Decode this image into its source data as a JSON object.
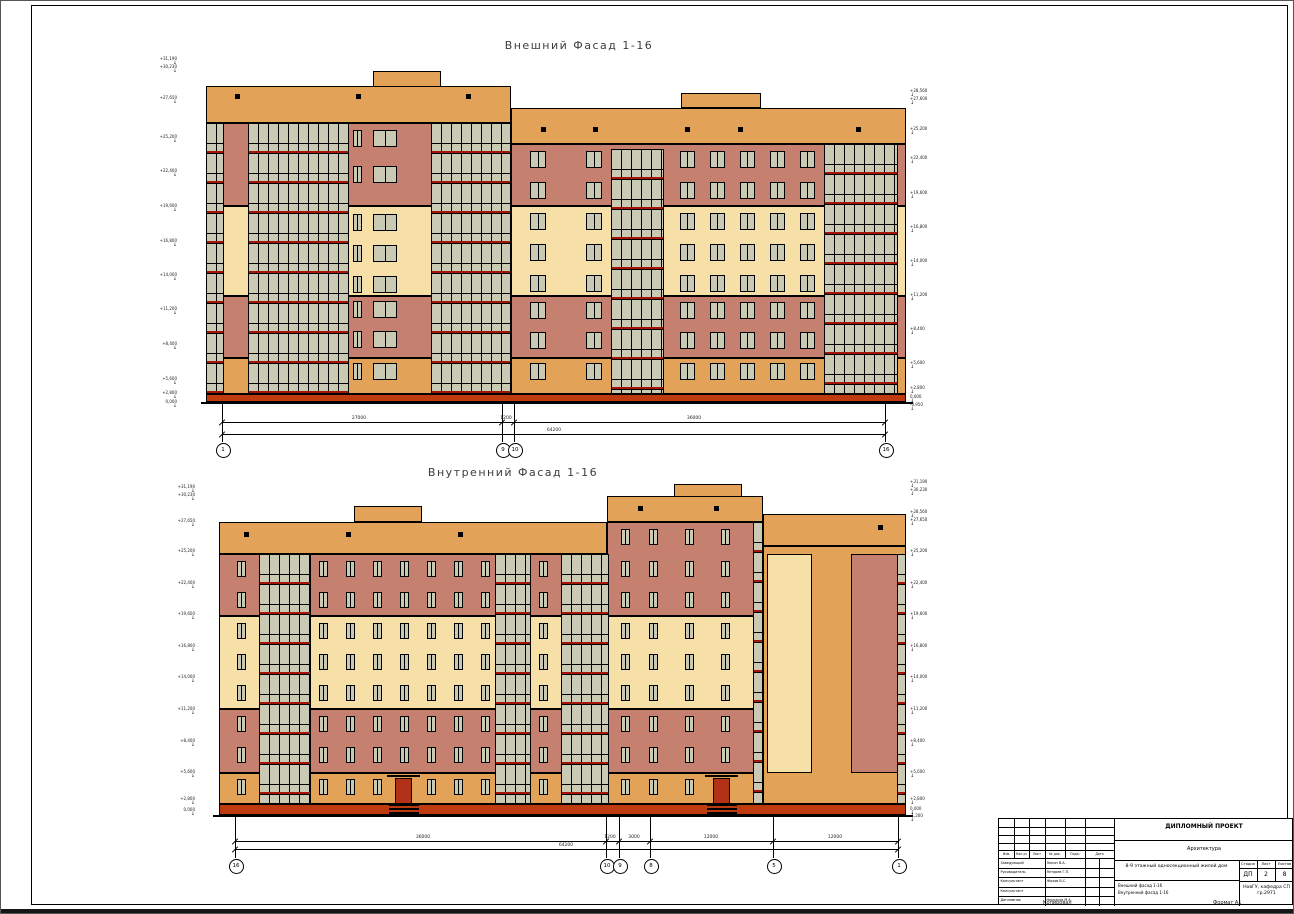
{
  "colors": {
    "orange": "#E2A257",
    "salmon": "#C6806F",
    "cream": "#F6E0A8",
    "pane": "#C9C9B4",
    "red": "#A51505",
    "plinth": "#BE3B10",
    "door": "#B23217"
  },
  "titles": {
    "facade_external": "Внешний Фасад 1-16",
    "facade_internal": "Внутренний Фасад 1-16"
  },
  "footer": {
    "copied": "Копировал",
    "format": "Формат А1"
  },
  "titleblock": {
    "project": "ДИПЛОМНЫЙ ПРОЕКТ",
    "department": "Архитектура",
    "object": "8-9 этажный односекционный жилой дом",
    "sheet_line1": "Внешний фасад 1-16",
    "sheet_line2": "Внутренний фасад 1-16",
    "stage_header": "Стадия",
    "list_header": "Лист",
    "lists_header": "Листов",
    "stage": "ДП",
    "list": "2",
    "lists": "8",
    "org": "НовГУ, кафедра СП гр.2971",
    "rev_headers": [
      "Изм.",
      "Кол.уч",
      "Лист",
      "№ док.",
      "Подп.",
      "Дата"
    ],
    "signature_rows": [
      [
        "Заведующий",
        "Ланин В.А."
      ],
      [
        "Руководитель",
        "Янтарев Г.П."
      ],
      [
        "Консультант",
        "Жохов В.С."
      ],
      [
        "Консультант",
        ""
      ],
      [
        "Дипломник",
        "Некрасов М.А."
      ]
    ]
  },
  "drawing": {
    "rects": [
      [
        372,
        70,
        68,
        16,
        "orange"
      ],
      [
        205,
        85,
        305,
        37,
        "orange"
      ],
      [
        680,
        92,
        80,
        15,
        "orange"
      ],
      [
        510,
        107,
        395,
        36,
        "orange"
      ],
      [
        205,
        122,
        305,
        83,
        "salmon"
      ],
      [
        205,
        205,
        305,
        90,
        "cream"
      ],
      [
        205,
        295,
        305,
        62,
        "salmon"
      ],
      [
        205,
        357,
        305,
        36,
        "orange"
      ],
      [
        510,
        143,
        395,
        62,
        "salmon"
      ],
      [
        510,
        205,
        395,
        90,
        "cream"
      ],
      [
        510,
        295,
        395,
        62,
        "salmon"
      ],
      [
        510,
        357,
        395,
        36,
        "orange"
      ],
      [
        205,
        393,
        700,
        8,
        "plinth"
      ],
      [
        353,
        505,
        68,
        16,
        "orange"
      ],
      [
        218,
        521,
        388,
        32,
        "orange"
      ],
      [
        673,
        483,
        68,
        13,
        "orange"
      ],
      [
        606,
        495,
        156,
        26,
        "orange"
      ],
      [
        762,
        513,
        143,
        32,
        "orange"
      ],
      [
        218,
        553,
        388,
        62,
        "salmon"
      ],
      [
        218,
        615,
        388,
        93,
        "cream"
      ],
      [
        218,
        708,
        388,
        64,
        "salmon"
      ],
      [
        218,
        772,
        388,
        31,
        "orange"
      ],
      [
        606,
        521,
        156,
        94,
        "salmon"
      ],
      [
        606,
        615,
        156,
        93,
        "cream"
      ],
      [
        606,
        708,
        156,
        64,
        "salmon"
      ],
      [
        606,
        772,
        156,
        31,
        "orange"
      ],
      [
        762,
        545,
        143,
        258,
        "orange"
      ],
      [
        766,
        553,
        45,
        219,
        "cream"
      ],
      [
        850,
        553,
        48,
        219,
        "salmon"
      ],
      [
        218,
        803,
        687,
        11,
        "plinth"
      ]
    ],
    "glazing": [
      [
        205,
        122,
        18,
        271
      ],
      [
        247,
        122,
        101,
        271
      ],
      [
        430,
        122,
        80,
        271
      ],
      [
        610,
        148,
        53,
        245
      ],
      [
        823,
        143,
        74,
        250
      ],
      [
        258,
        553,
        52,
        250
      ],
      [
        494,
        553,
        36,
        250
      ],
      [
        560,
        553,
        48,
        250
      ],
      [
        752,
        521,
        10,
        282
      ],
      [
        896,
        553,
        9,
        250
      ]
    ],
    "window_sets": [
      {
        "cols": [
          352
        ],
        "w": 9,
        "rows": [
          129,
          165,
          213,
          244,
          275,
          300,
          330,
          362
        ],
        "h": 17
      },
      {
        "cols": [
          372
        ],
        "w": 24,
        "rows": [
          129,
          165,
          213,
          244,
          275,
          300,
          330,
          362
        ],
        "h": 17
      },
      {
        "cols": [
          529,
          585
        ],
        "w": 16,
        "rows": [
          150,
          181,
          212,
          243,
          274,
          301,
          331,
          362
        ],
        "h": 17
      },
      {
        "cols": [
          679,
          709,
          739,
          769,
          799
        ],
        "w": 15,
        "rows": [
          150,
          181,
          212,
          243,
          274,
          301,
          331,
          362
        ],
        "h": 17
      },
      {
        "cols": [
          236,
          318,
          345,
          372,
          399,
          426,
          453,
          480,
          538
        ],
        "w": 9,
        "rows": [
          560,
          591,
          622,
          653,
          684,
          715,
          746,
          778
        ],
        "h": 16
      },
      {
        "cols": [
          620,
          648,
          684,
          720
        ],
        "w": 9,
        "rows": [
          528,
          560,
          591,
          622,
          653,
          684,
          715,
          746,
          778
        ],
        "h": 16
      }
    ],
    "squares": [
      [
        234,
        93
      ],
      [
        355,
        93
      ],
      [
        465,
        93
      ],
      [
        540,
        126
      ],
      [
        592,
        126
      ],
      [
        684,
        126
      ],
      [
        737,
        126
      ],
      [
        855,
        126
      ],
      [
        243,
        531
      ],
      [
        345,
        531
      ],
      [
        457,
        531
      ],
      [
        637,
        505
      ],
      [
        713,
        505
      ],
      [
        877,
        524
      ]
    ],
    "doors": [
      [
        394,
        777,
        17,
        26
      ],
      [
        712,
        777,
        17,
        26
      ]
    ],
    "canopies": [
      [
        386,
        774,
        33,
        2
      ],
      [
        704,
        774,
        33,
        2
      ]
    ],
    "steps": [
      [
        388,
        803,
        30,
        10
      ],
      [
        706,
        803,
        30,
        10
      ]
    ],
    "ground_lines": [
      [
        200,
        401,
        712
      ],
      [
        212,
        814,
        700
      ]
    ],
    "elevations": [
      {
        "x": 176,
        "align": "r",
        "marks": [
          [
            56,
            "+31,190"
          ],
          [
            64,
            "+30,230"
          ],
          [
            95,
            "+27,650"
          ],
          [
            134,
            "+25,200"
          ],
          [
            168,
            "+22,400"
          ],
          [
            203,
            "+19,600"
          ],
          [
            238,
            "+16,800"
          ],
          [
            272,
            "+14,000"
          ],
          [
            306,
            "+11,200"
          ],
          [
            341,
            "+8,400"
          ],
          [
            376,
            "+5,600"
          ],
          [
            390,
            "+2,800"
          ],
          [
            399,
            "0,000"
          ]
        ]
      },
      {
        "x": 909,
        "align": "l",
        "marks": [
          [
            88,
            "+28,560"
          ],
          [
            96,
            "+27,600"
          ],
          [
            126,
            "+25,200"
          ],
          [
            155,
            "+22,400"
          ],
          [
            190,
            "+19,600"
          ],
          [
            224,
            "+16,800"
          ],
          [
            258,
            "+14,000"
          ],
          [
            292,
            "+11,200"
          ],
          [
            326,
            "+8,400"
          ],
          [
            360,
            "+5,600"
          ],
          [
            385,
            "+2,800"
          ],
          [
            394,
            "0,000"
          ],
          [
            402,
            "-0,950"
          ]
        ]
      },
      {
        "x": 194,
        "align": "r",
        "marks": [
          [
            484,
            "+31,190"
          ],
          [
            492,
            "+30,230"
          ],
          [
            518,
            "+27,650"
          ],
          [
            548,
            "+25,200"
          ],
          [
            580,
            "+22,400"
          ],
          [
            611,
            "+19,600"
          ],
          [
            643,
            "+16,800"
          ],
          [
            674,
            "+14,000"
          ],
          [
            706,
            "+11,200"
          ],
          [
            738,
            "+8,400"
          ],
          [
            769,
            "+5,600"
          ],
          [
            796,
            "+2,800"
          ],
          [
            807,
            "0,000"
          ]
        ]
      },
      {
        "x": 909,
        "align": "l",
        "marks": [
          [
            479,
            "+31,190"
          ],
          [
            487,
            "+30,230"
          ],
          [
            509,
            "+28,560"
          ],
          [
            517,
            "+27,650"
          ],
          [
            548,
            "+25,200"
          ],
          [
            580,
            "+22,400"
          ],
          [
            611,
            "+19,600"
          ],
          [
            643,
            "+16,800"
          ],
          [
            674,
            "+14,000"
          ],
          [
            706,
            "+11,200"
          ],
          [
            738,
            "+8,400"
          ],
          [
            769,
            "+5,600"
          ],
          [
            796,
            "+2,800"
          ],
          [
            806,
            "0,000"
          ],
          [
            813,
            "-1,200"
          ]
        ]
      }
    ],
    "dim_sets": [
      {
        "lines": [
          {
            "y": 421,
            "x1": 221,
            "x2": 884,
            "ticks": [
              221,
              501,
              513,
              884
            ],
            "labels": [
              [
                358,
                "27000"
              ],
              [
                505,
                "1200"
              ],
              [
                693,
                "36000"
              ]
            ]
          },
          {
            "y": 433,
            "x1": 221,
            "x2": 884,
            "ticks": [
              221,
              884
            ],
            "labels": [
              [
                553,
                "64200"
              ]
            ]
          }
        ],
        "ext": {
          "xs": [
            221,
            501,
            513,
            884
          ],
          "y1": 403,
          "y2": 441
        },
        "bubbles": {
          "y": 448,
          "items": [
            [
              221,
              "1"
            ],
            [
              501,
              "9"
            ],
            [
              513,
              "10"
            ],
            [
              884,
              "16"
            ]
          ]
        }
      },
      {
        "lines": [
          {
            "y": 840,
            "x1": 234,
            "x2": 897,
            "ticks": [
              234,
              605,
              618,
              649,
              772,
              897
            ],
            "labels": [
              [
                422,
                "36000"
              ],
              [
                609,
                "1200"
              ],
              [
                633,
                "3000"
              ],
              [
                710,
                "12000"
              ],
              [
                834,
                "12000"
              ]
            ]
          },
          {
            "y": 848,
            "x1": 234,
            "x2": 897,
            "ticks": [
              234,
              897
            ],
            "labels": [
              [
                565,
                "64200"
              ]
            ]
          }
        ],
        "ext": {
          "xs": [
            234,
            605,
            618,
            649,
            772,
            897
          ],
          "y1": 816,
          "y2": 857
        },
        "bubbles": {
          "y": 864,
          "items": [
            [
              234,
              "16"
            ],
            [
              605,
              "10"
            ],
            [
              618,
              "9"
            ],
            [
              649,
              "8"
            ],
            [
              772,
              "5"
            ],
            [
              897,
              "1"
            ]
          ]
        }
      }
    ]
  }
}
